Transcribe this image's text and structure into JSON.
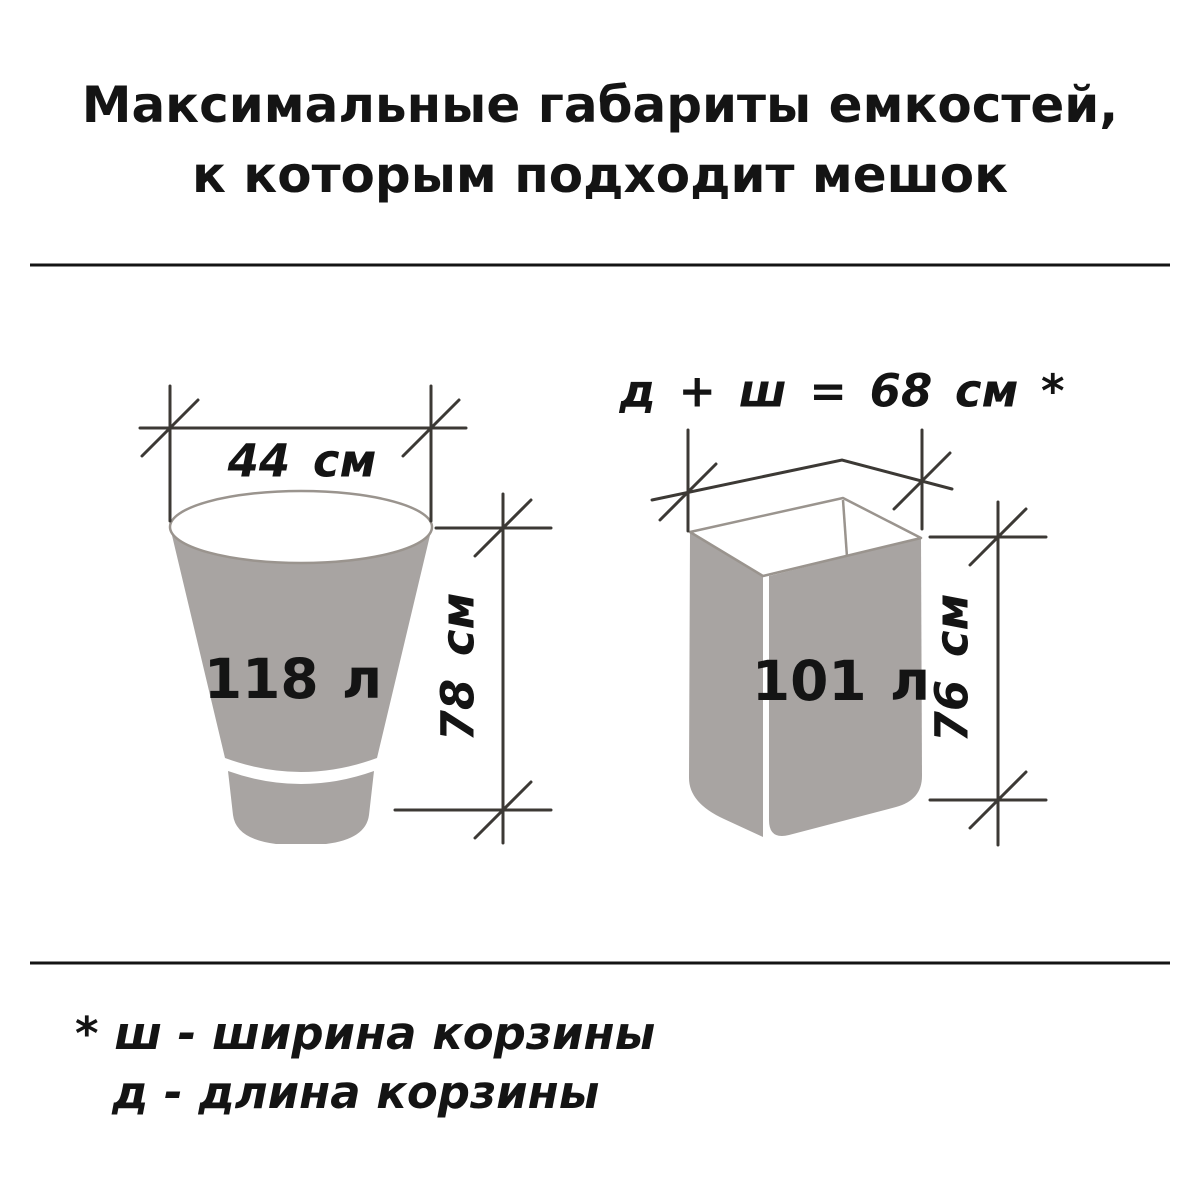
{
  "title": {
    "line1": "Максимальные габариты емкостей,",
    "line2": "к которым подходит мешок"
  },
  "bucket": {
    "volume": "118 л",
    "width_label": "44 см",
    "height_label": "78 см"
  },
  "basket": {
    "volume": "101 л",
    "sum_label": "д + ш = 68 см *",
    "height_label": "76 см"
  },
  "footnote": {
    "line1": "* ш - ширина корзины",
    "line2": "д - длина корзины"
  },
  "colors": {
    "text_black": "#141414",
    "line_dark": "#3c3935",
    "fill_gray": "#a8a4a2",
    "outline_gray": "#9a948e",
    "bg_white": "#ffffff"
  }
}
